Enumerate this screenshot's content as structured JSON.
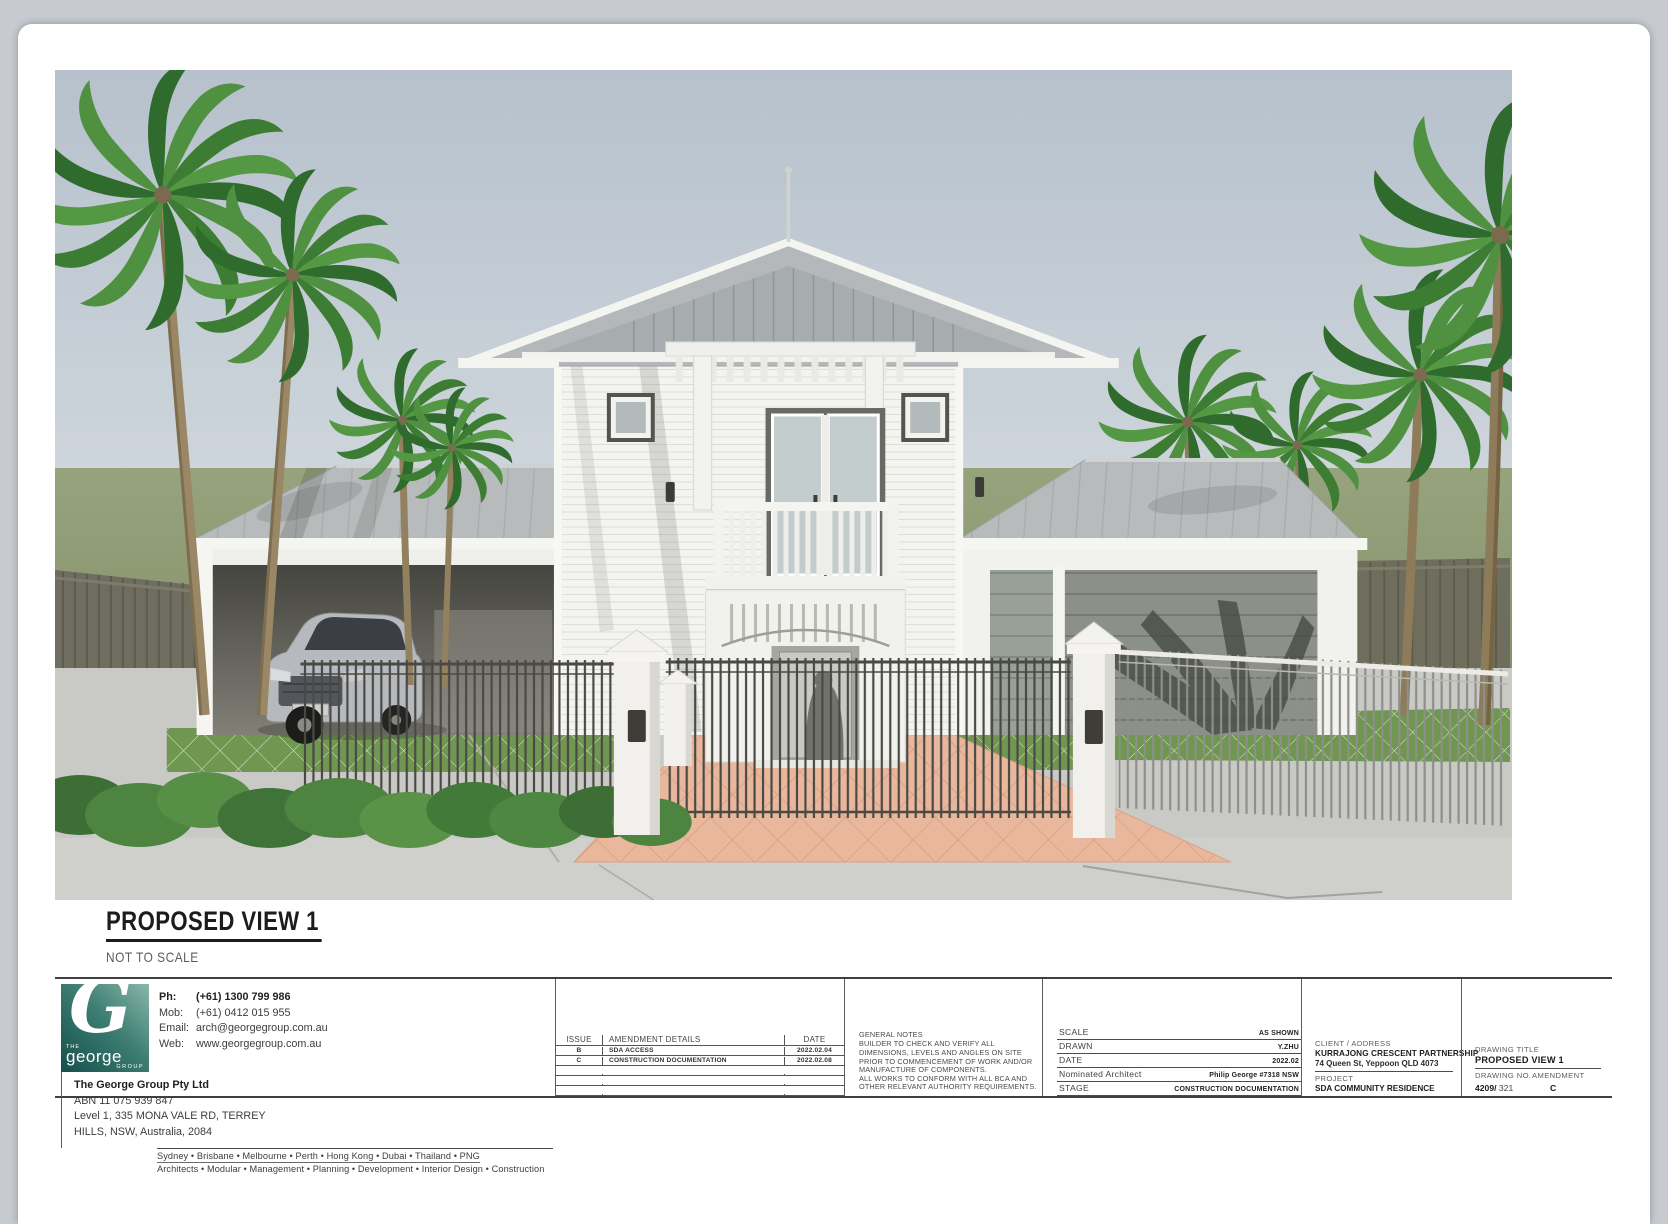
{
  "view": {
    "heading": "PROPOSED VIEW 1",
    "subheading": "NOT TO SCALE"
  },
  "colors": {
    "brand_teal": "#1b5a52",
    "sky_top": "#b6c1cc",
    "hedge_green": "#8e9b72",
    "lawn_green": "#6f9751",
    "palm_green": "#3f7c36",
    "paving_peach": "#e9b79c",
    "roof_gray": "#b7bbbd",
    "wall_white": "#f3f3f0"
  },
  "title_block": {
    "company": {
      "logo_the": "THE",
      "logo_name": "george",
      "logo_group": "GROUP",
      "phone_label": "Ph:",
      "phone": "(+61) 1300 799 986",
      "mob_label": "Mob:",
      "mob": "(+61) 0412 015 955",
      "email_label": "Email:",
      "email": "arch@georgegroup.com.au",
      "web_label": "Web:",
      "web": "www.georgegroup.com.au",
      "name": "The George Group Pty Ltd",
      "abn": "ABN 11 075 939 847",
      "address_line1": "Level 1, 335 MONA VALE RD, TERREY",
      "address_line2": "HILLS, NSW, Australia, 2084",
      "cities": "Sydney  •  Brisbane  •  Melbourne  •  Perth  •  Hong Kong  •  Dubai  •  Thailand  •  PNG",
      "services": "Architects • Modular • Management • Planning • Development • Interior Design • Construction"
    },
    "amendments": {
      "headers": {
        "issue": "ISSUE",
        "details": "AMENDMENT DETAILS",
        "date": "DATE"
      },
      "rows": [
        {
          "issue": "B",
          "details": "SDA ACCESS",
          "date": "2022.02.04"
        },
        {
          "issue": "C",
          "details": "CONSTRUCTION DOCUMENTATION",
          "date": "2022.02.08"
        }
      ]
    },
    "general_notes": {
      "title": "GENERAL NOTES",
      "lines": [
        "BUILDER TO CHECK AND VERIFY ALL",
        "DIMENSIONS, LEVELS AND ANGLES ON SITE",
        "PRIOR TO COMMENCEMENT OF WORK AND/OR",
        "MANUFACTURE OF COMPONENTS.",
        "ALL WORKS TO CONFORM WITH ALL BCA AND",
        "OTHER RELEVANT AUTHORITY REQUIREMENTS."
      ]
    },
    "info": {
      "scale_label": "SCALE",
      "scale": "AS SHOWN",
      "drawn_label": "DRAWN",
      "drawn": "Y.ZHU",
      "date_label": "DATE",
      "date": "2022.02",
      "architect_label": "Nominated Architect",
      "architect": "Philip George #7318 NSW",
      "stage_label": "STAGE",
      "stage": "CONSTRUCTION DOCUMENTATION"
    },
    "client": {
      "label": "CLIENT / ADDRESS",
      "name": "KURRAJONG CRESCENT PARTNERSHIP",
      "address": "74 Queen St, Yeppoon QLD 4073",
      "project_label": "PROJECT",
      "project": "SDA COMMUNITY RESIDENCE"
    },
    "drawing": {
      "title_label": "DRAWING TITLE",
      "title": "PROPOSED VIEW 1",
      "number_label": "DRAWING NO.",
      "number_prefix": "4209/",
      "number_suffix": "321",
      "amendment_label": "AMENDMENT",
      "amendment": "C"
    }
  }
}
